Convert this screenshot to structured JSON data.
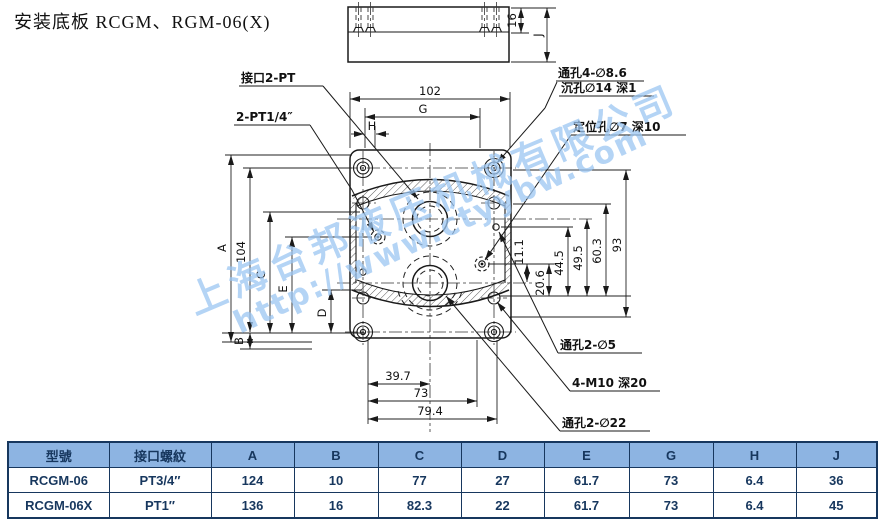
{
  "title": "安装底板 RCGM、RGM-06(X)",
  "watermark": {
    "company": "上海台邦液压机械有限公司",
    "url": "http://www.ctyybw.com",
    "color": "#9cc6f2"
  },
  "drawing": {
    "callouts": {
      "port_2pt": "接口2-PT",
      "port_pt14": "2-PT1/4″",
      "through_4_86": "通孔4-∅8.6",
      "cbore_14": "沉孔∅14 深1",
      "locating_7": "定位孔∅7 深10",
      "through_2_5": "通孔2-∅5",
      "m10": "4-M10 深20",
      "through_2_22": "通孔2-∅22"
    },
    "dims": {
      "w102": "102",
      "G": "G",
      "H": "H",
      "A": "A",
      "h104": "104",
      "C": "C",
      "E": "E",
      "D": "D",
      "B": "B",
      "r11_1": "11.1",
      "r20_6": "20.6",
      "r44_5": "44.5",
      "r49_5": "49.5",
      "r60_3": "60.3",
      "r93": "93",
      "b39_7": "39.7",
      "b73": "73",
      "b79_4": "79.4",
      "t16": "16",
      "J": "J"
    }
  },
  "table": {
    "header_bg": "#8DB4E2",
    "border_color": "#17375E",
    "text_color": "#17375E",
    "headers": [
      "型號",
      "接口螺紋",
      "A",
      "B",
      "C",
      "D",
      "E",
      "G",
      "H",
      "J"
    ],
    "rows": [
      [
        "RCGM-06",
        "PT3/4″",
        "124",
        "10",
        "77",
        "27",
        "61.7",
        "73",
        "6.4",
        "36"
      ],
      [
        "RCGM-06X",
        "PT1″",
        "136",
        "16",
        "82.3",
        "22",
        "61.7",
        "73",
        "6.4",
        "45"
      ]
    ]
  }
}
